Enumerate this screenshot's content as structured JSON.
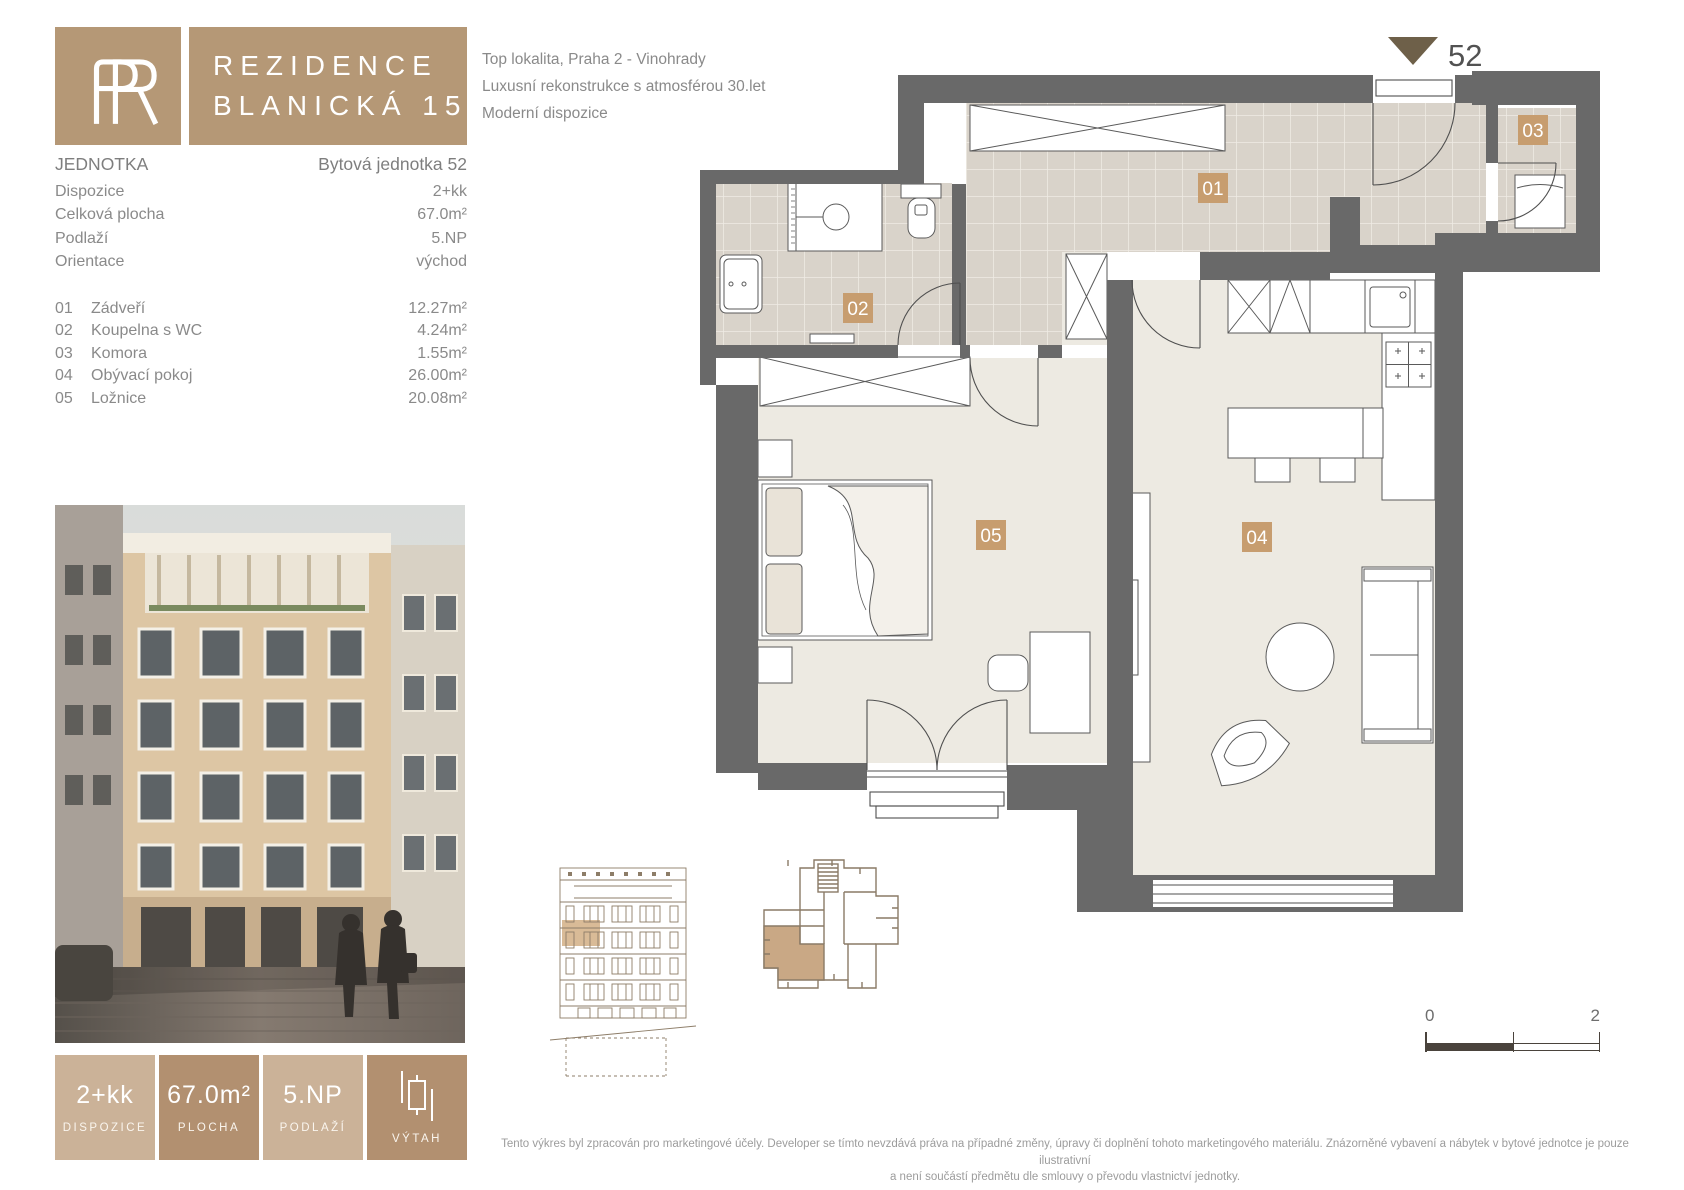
{
  "brand": {
    "monogram": "PR",
    "title_line1": "REZIDENCE",
    "title_line2": "BLANICKÁ 15"
  },
  "intro": {
    "line1": "Top lokalita, Praha 2 - Vinohrady",
    "line2": "Luxusní rekonstrukce s atmosférou 30.let",
    "line3": "Moderní dispozice"
  },
  "unit": {
    "section_label": "JEDNOTKA",
    "section_value": "Bytová jednotka 52",
    "rows": [
      {
        "label": "Dispozice",
        "value": "2+kk"
      },
      {
        "label": "Celková plocha",
        "value": "67.0m²"
      },
      {
        "label": "Podlaží",
        "value": "5.NP"
      },
      {
        "label": "Orientace",
        "value": "východ"
      }
    ]
  },
  "rooms": [
    {
      "num": "01",
      "name": "Zádveří",
      "area": "12.27m²"
    },
    {
      "num": "02",
      "name": "Koupelna s WC",
      "area": "4.24m²"
    },
    {
      "num": "03",
      "name": "Komora",
      "area": "1.55m²"
    },
    {
      "num": "04",
      "name": "Obývací pokoj",
      "area": "26.00m²"
    },
    {
      "num": "05",
      "name": "Ložnice",
      "area": "20.08m²"
    }
  ],
  "plan": {
    "unit_marker": "52",
    "badges": [
      "01",
      "02",
      "03",
      "04",
      "05"
    ]
  },
  "badges": [
    {
      "value": "2+kk",
      "label": "DISPOZICE"
    },
    {
      "value": "67.0m²",
      "label": "PLOCHA"
    },
    {
      "value": "5.NP",
      "label": "PODLAŽÍ"
    },
    {
      "value": "",
      "label": "VÝTAH"
    }
  ],
  "scalebar": {
    "start": "0",
    "end": "2"
  },
  "disclaimer": {
    "line1": "Tento výkres byl zpracován pro marketingové účely. Developer se tímto nevzdává práva na případné změny, úpravy či doplnění tohoto marketingového materiálu. Znázorněné vybavení a nábytek v bytové jednotce je pouze ilustrativní",
    "line2": "a není součástí předmětu dle smlouvy o převodu vlastnictví jednotky."
  },
  "colors": {
    "brand_tan": "#b59876",
    "badge_light": "#cbb298",
    "badge_dark": "#b29070",
    "room_badge": "#c79d6f",
    "wall_gray": "#696969",
    "tile": "#d9d3ca",
    "floor": "#edeae2"
  }
}
